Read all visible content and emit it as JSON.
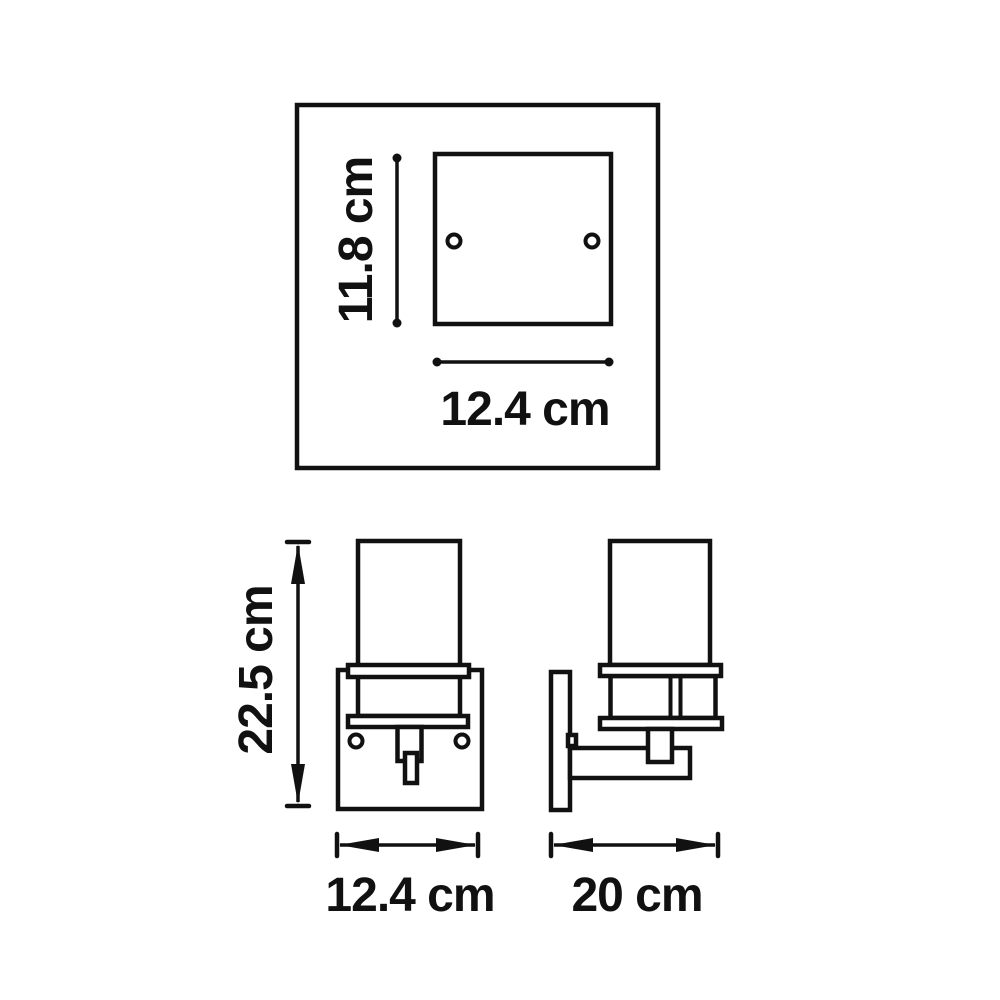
{
  "drawing": {
    "colors": {
      "line": "#111111",
      "background": "#ffffff"
    },
    "views": {
      "top": {
        "height_label": "11.8 cm",
        "width_label": "12.4 cm"
      },
      "front": {
        "height_label": "22.5 cm",
        "width_label": "12.4 cm"
      },
      "side": {
        "depth_label": "20 cm"
      }
    }
  }
}
